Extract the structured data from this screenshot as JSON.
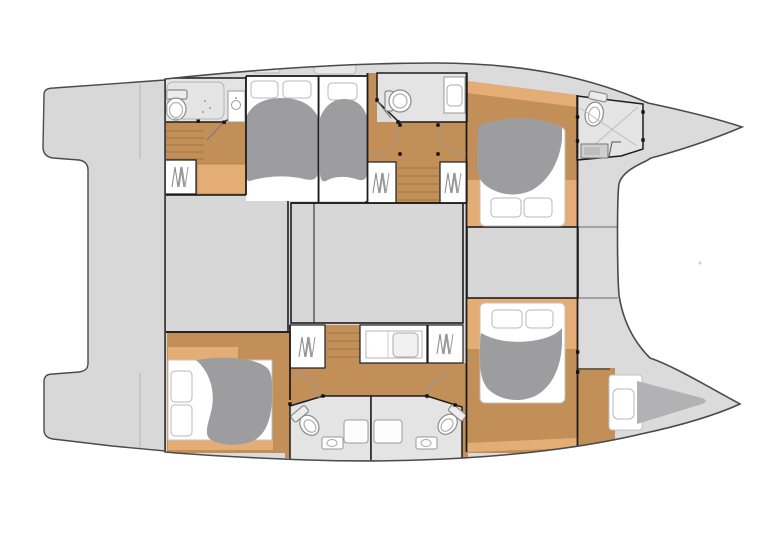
{
  "semantics": {
    "diagram_kind": "catamaran-deck-floor-plan",
    "orientation": "bow-right",
    "rooms": [
      {
        "id": "stern-platform",
        "label": "stern platform / transom steps"
      },
      {
        "id": "cockpit-block",
        "label": "aft cockpit block"
      },
      {
        "id": "salon-block",
        "label": "salon block"
      },
      {
        "id": "foredeck-block",
        "label": "foredeck block"
      },
      {
        "id": "aft-head-port",
        "label": "port aft bathroom"
      },
      {
        "id": "aft-cabin-port",
        "label": "port aft cabin"
      },
      {
        "id": "mid-cabin-port",
        "label": "port mid cabin"
      },
      {
        "id": "mid-head-port",
        "label": "port mid bathroom"
      },
      {
        "id": "fwd-cabin-port",
        "label": "port forward cabin"
      },
      {
        "id": "bow-head-port",
        "label": "port bow bathroom"
      },
      {
        "id": "aft-cabin-stbd",
        "label": "starboard aft cabin"
      },
      {
        "id": "head-stbd-left",
        "label": "starboard aft-facing bathroom"
      },
      {
        "id": "head-stbd-right",
        "label": "starboard fwd-facing bathroom"
      },
      {
        "id": "fwd-cabin-stbd",
        "label": "starboard forward cabin"
      },
      {
        "id": "bow-berth-stbd",
        "label": "starboard bow berth"
      }
    ],
    "fixtures": [
      "toilet",
      "sink",
      "shower",
      "bed",
      "pillow",
      "duvet",
      "hanging-locker",
      "vanity",
      "steps",
      "door-swing",
      "hinge-dot",
      "deck-hatch"
    ]
  },
  "palette": {
    "bg": "#ffffff",
    "deck": "#dbdbdb",
    "platform": "#d8d8d8",
    "block": "#d7d7d7",
    "bath": "#e4e4e4",
    "wood": "#c28f58",
    "woodLight": "#e5ad76",
    "woodLine": "#9c713d",
    "white": "#ffffff",
    "duvet": "#9d9da0",
    "berth": "#b2b2b4",
    "outline": "#4a4a4a",
    "wall": "#1d1d1d",
    "fixture": "#8a8a8a",
    "faint": "#bdbdbd",
    "hatch": "#e7e7e7"
  }
}
